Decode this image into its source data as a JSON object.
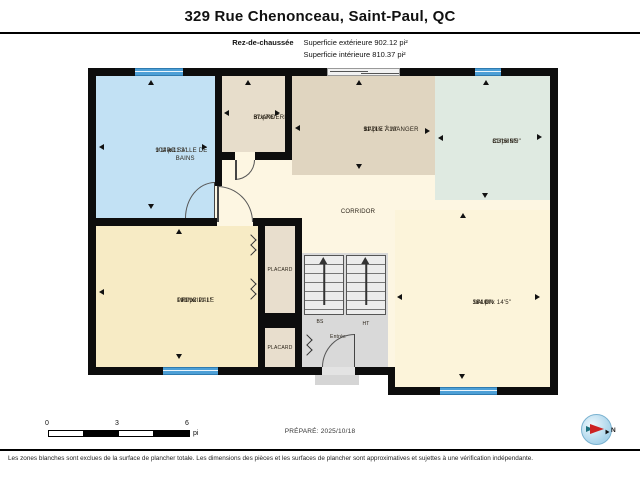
{
  "header": {
    "title": "329 Rue Chenonceau, Saint-Paul, QC",
    "floor_label": "Rez-de-chaussée",
    "area_exterior": "Superficie extérieure 902.12 pi²",
    "area_interior": "Superficie intérieure 810.37 pi²"
  },
  "rooms": {
    "bathroom": {
      "name": "4PC SALLE DE BAINS",
      "dims": "9'1\" x 11'3\"",
      "area": "102 pi²"
    },
    "laundry": {
      "name": "BUANDERIE",
      "dims": "5' x 7'6\"",
      "area": "37 pi²"
    },
    "dining": {
      "name": "SALLE À MANGER",
      "dims": "11'7\" x 7'10\"",
      "area": "91 pi²"
    },
    "kitchen": {
      "name": "CUISINE",
      "dims": "8'3\" x 9'9\"",
      "area": "81 pi²"
    },
    "corridor": {
      "name": "CORRIDOR"
    },
    "primary": {
      "name": "PRINCIPALE",
      "dims": "12'9\" x 11'1\"",
      "area": "141 pi²"
    },
    "closet1": {
      "name": "PLACARD"
    },
    "closet2": {
      "name": "PLACARD"
    },
    "living": {
      "name": "SALON",
      "dims": "11'10\" x 14'5\"",
      "area": "164 pi²"
    },
    "stair_down": {
      "name": "BS"
    },
    "stair_up": {
      "name": "HT"
    },
    "entry": {
      "name": "Entrée"
    }
  },
  "scale_bar": {
    "tick0": "0",
    "tick3": "3",
    "tick6": "6",
    "unit": "pi"
  },
  "prepared": {
    "text": "PRÉPARÉ: 2025/10/18"
  },
  "compass": {
    "north_label": "N"
  },
  "footer": {
    "disclaimer": "Les zones blanches sont exclues de la surface de plancher totale. Les dimensions des pièces et les surfaces de plancher sont approximatives et sujettes à une vérification indépendante."
  },
  "colors": {
    "wall": "#0d0d0d",
    "room_bathroom": "#c2e1f4",
    "room_laundry": "#e7ddcb",
    "room_dining": "#e0d5c0",
    "room_kitchen": "#dfeae1",
    "room_corridor": "#fdf6e2",
    "room_primary": "#f7ebc5",
    "room_living": "#fcf4da",
    "room_closet": "#e8decd",
    "stairs_area": "#d9d9d9",
    "stairs_flight": "#ececec",
    "window_blue": "#4d9fd6",
    "compass_blue": "#a8d3ea",
    "compass_needle": "#cc2222"
  }
}
